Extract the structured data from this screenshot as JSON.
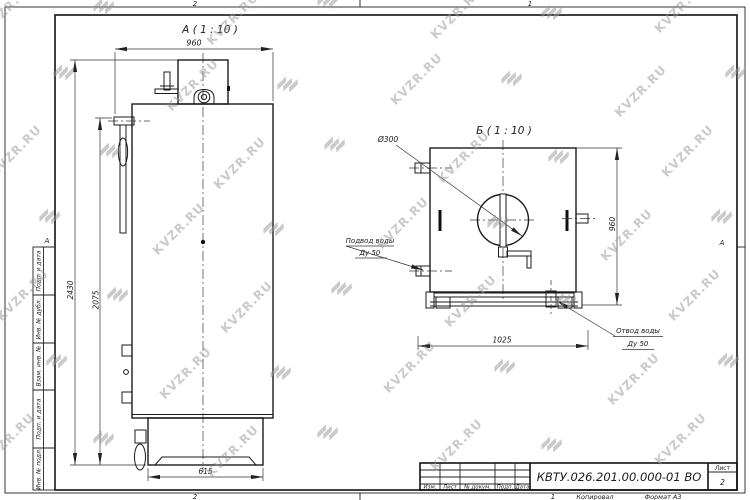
{
  "watermark": {
    "text": "KVZR.RU"
  },
  "frame": {
    "zone_top_left": "2",
    "zone_top_right": "1",
    "zone_bottom_left": "2",
    "zone_bottom_right": "1",
    "zone_side_left": "А",
    "zone_side_right": "А",
    "copied_label": "Копировал",
    "format_label": "Формат А3",
    "left_block": {
      "labels": [
        "Подп. и дата",
        "Инв. № дубл.",
        "Взам. инв. №",
        "Подп. и дата",
        "Инв. № подл."
      ]
    }
  },
  "title_block": {
    "doc_number": "КВТУ.026.201.00.000-01 ВО",
    "header_cells": [
      "Изм.",
      "Лист",
      "№ докум.",
      "Подп.",
      "Дата"
    ],
    "sheet_label": "Лист",
    "sheet_number": "2"
  },
  "view_a": {
    "title": "А ( 1 : 10 )",
    "dim_width_top": "960",
    "dim_height_overall": "2430",
    "dim_height_body": "2075",
    "dim_base_width": "615"
  },
  "view_b": {
    "title": "Б ( 1 : 10 )",
    "dim_flue_diameter": "Ø300",
    "dim_height_right": "960",
    "dim_base_width": "1025",
    "inlet_label_line1": "Подвод воды",
    "inlet_label_line2": "Ду 50",
    "outlet_label_line1": "Отвод воды",
    "outlet_label_line2": "Ду 50"
  }
}
